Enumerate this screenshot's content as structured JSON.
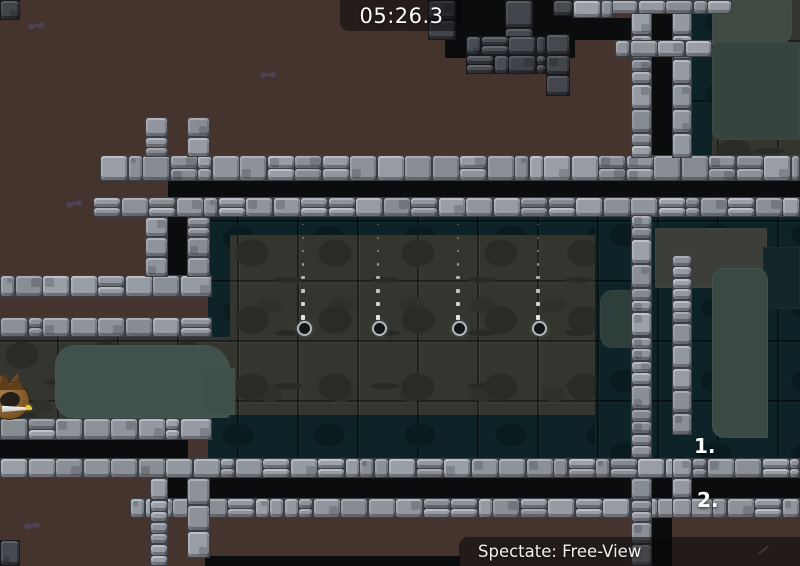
{
  "hud": {
    "timer": "05:26.3",
    "rank1": "1.",
    "rank2": "2.",
    "spectate_label": "Spectate: Free-View"
  },
  "colors": {
    "background_brown": "#45342e",
    "void_black": "#0a0c0d",
    "water_teal": "#0d2327",
    "room_grey": "#34352f",
    "brick_light": "#90949c",
    "brick_dark": "#46494f",
    "hud_overlay": "rgba(5,5,8,0.5)",
    "hud_text": "#ffffff"
  },
  "map": {
    "blacks": [
      {
        "x": 445,
        "y": 0,
        "w": 130,
        "h": 58
      },
      {
        "x": 575,
        "y": 18,
        "w": 112,
        "h": 22
      },
      {
        "x": 168,
        "y": 217,
        "w": 22,
        "h": 60
      },
      {
        "x": 168,
        "y": 177,
        "w": 632,
        "h": 20
      },
      {
        "x": 650,
        "y": 13,
        "w": 22,
        "h": 147
      },
      {
        "x": 652,
        "y": 315,
        "w": 20,
        "h": 143,
        "c": "#0a1315"
      },
      {
        "x": 0,
        "y": 440,
        "w": 188,
        "h": 18
      },
      {
        "x": 168,
        "y": 478,
        "w": 632,
        "h": 20
      },
      {
        "x": 652,
        "y": 518,
        "w": 20,
        "h": 48
      },
      {
        "x": 205,
        "y": 556,
        "w": 255,
        "h": 10
      }
    ],
    "waters": [
      {
        "x": 208,
        "y": 215,
        "w": 487,
        "h": 25
      },
      {
        "x": 690,
        "y": 0,
        "w": 22,
        "h": 177
      },
      {
        "x": 208,
        "y": 217,
        "w": 25,
        "h": 128
      },
      {
        "x": 208,
        "y": 413,
        "w": 432,
        "h": 45
      },
      {
        "x": 595,
        "y": 213,
        "w": 205,
        "h": 245
      }
    ],
    "rooms": [
      {
        "x": 230,
        "y": 235,
        "w": 365,
        "h": 180
      },
      {
        "x": 0,
        "y": 337,
        "w": 230,
        "h": 81
      },
      {
        "x": 712,
        "y": 0,
        "w": 88,
        "h": 177
      }
    ],
    "patches": [
      {
        "x": 712,
        "y": 0,
        "w": 80,
        "h": 45,
        "c": "#3f4a43",
        "r": "0 0 14px 0"
      },
      {
        "x": 712,
        "y": 42,
        "w": 88,
        "h": 98,
        "c": "#36443f",
        "r": "10px 0 0 10px"
      },
      {
        "x": 55,
        "y": 345,
        "w": 175,
        "h": 73,
        "c": "#41514c",
        "r": "20px 26px 6px 18px"
      },
      {
        "x": 203,
        "y": 368,
        "w": 32,
        "h": 47,
        "c": "#3f4f4a",
        "r": "10px 2px 2px 12px"
      },
      {
        "x": 655,
        "y": 228,
        "w": 112,
        "h": 60,
        "c": "#3c3e39",
        "r": "2px 2px 16px 2px"
      },
      {
        "x": 763,
        "y": 247,
        "w": 37,
        "h": 62,
        "c": "#132629",
        "r": "0 0 0 14px"
      },
      {
        "x": 712,
        "y": 268,
        "w": 56,
        "h": 170,
        "c": "#3c4a46",
        "r": "12px 12px 0 12px"
      },
      {
        "x": 600,
        "y": 290,
        "w": 42,
        "h": 58,
        "c": "#2e3e3a",
        "r": "12px"
      }
    ],
    "bricks": [
      {
        "x": 100,
        "y": 155,
        "w": 700,
        "h": 26,
        "s": "light"
      },
      {
        "x": 93,
        "y": 197,
        "w": 707,
        "h": 20,
        "s": "light"
      },
      {
        "x": 0,
        "y": 275,
        "w": 212,
        "h": 22,
        "s": "light"
      },
      {
        "x": 0,
        "y": 317,
        "w": 212,
        "h": 20,
        "s": "light"
      },
      {
        "x": 0,
        "y": 418,
        "w": 212,
        "h": 22,
        "s": "light"
      },
      {
        "x": 0,
        "y": 458,
        "w": 800,
        "h": 20,
        "s": "light"
      },
      {
        "x": 130,
        "y": 498,
        "w": 670,
        "h": 20,
        "s": "light"
      },
      {
        "x": 145,
        "y": 117,
        "w": 23,
        "h": 40,
        "s": "light"
      },
      {
        "x": 187,
        "y": 117,
        "w": 23,
        "h": 40,
        "s": "light"
      },
      {
        "x": 145,
        "y": 217,
        "w": 23,
        "h": 60,
        "s": "light"
      },
      {
        "x": 187,
        "y": 217,
        "w": 23,
        "h": 60,
        "s": "light"
      },
      {
        "x": 150,
        "y": 478,
        "w": 18,
        "h": 88,
        "s": "light"
      },
      {
        "x": 187,
        "y": 478,
        "w": 23,
        "h": 80,
        "s": "light"
      },
      {
        "x": 631,
        "y": 10,
        "w": 21,
        "h": 148,
        "s": "light"
      },
      {
        "x": 631,
        "y": 215,
        "w": 21,
        "h": 243,
        "s": "light"
      },
      {
        "x": 631,
        "y": 478,
        "w": 21,
        "h": 88,
        "s": "light"
      },
      {
        "x": 672,
        "y": 10,
        "w": 20,
        "h": 148,
        "s": "light"
      },
      {
        "x": 672,
        "y": 255,
        "w": 20,
        "h": 180,
        "s": "light"
      },
      {
        "x": 672,
        "y": 458,
        "w": 20,
        "h": 60,
        "s": "light"
      },
      {
        "x": 610,
        "y": 0,
        "w": 122,
        "h": 14,
        "s": "light"
      },
      {
        "x": 573,
        "y": 0,
        "w": 40,
        "h": 18,
        "s": "light"
      },
      {
        "x": 615,
        "y": 40,
        "w": 97,
        "h": 17,
        "s": "light"
      },
      {
        "x": 0,
        "y": 0,
        "w": 20,
        "h": 20,
        "s": "dark"
      },
      {
        "x": 428,
        "y": 0,
        "w": 28,
        "h": 40,
        "s": "dark"
      },
      {
        "x": 505,
        "y": 0,
        "w": 28,
        "h": 56,
        "s": "dark"
      },
      {
        "x": 466,
        "y": 36,
        "w": 80,
        "h": 38,
        "s": "dark"
      },
      {
        "x": 546,
        "y": 34,
        "w": 24,
        "h": 62,
        "s": "dark"
      },
      {
        "x": 553,
        "y": 0,
        "w": 20,
        "h": 16,
        "s": "dark"
      },
      {
        "x": 0,
        "y": 540,
        "w": 20,
        "h": 26,
        "s": "dark"
      }
    ]
  },
  "drips": {
    "columns": [
      303,
      378,
      458,
      538
    ],
    "top": 224,
    "spacing": 13,
    "count": 8,
    "circle_y": 321
  },
  "decos": [
    {
      "x": 30,
      "y": 24,
      "rot": -8
    },
    {
      "x": 262,
      "y": 73,
      "rot": -4
    },
    {
      "x": 68,
      "y": 202,
      "rot": -10
    },
    {
      "x": 26,
      "y": 524,
      "rot": -6
    }
  ],
  "tee": {
    "skin": "brown-fox",
    "facing": "right"
  }
}
